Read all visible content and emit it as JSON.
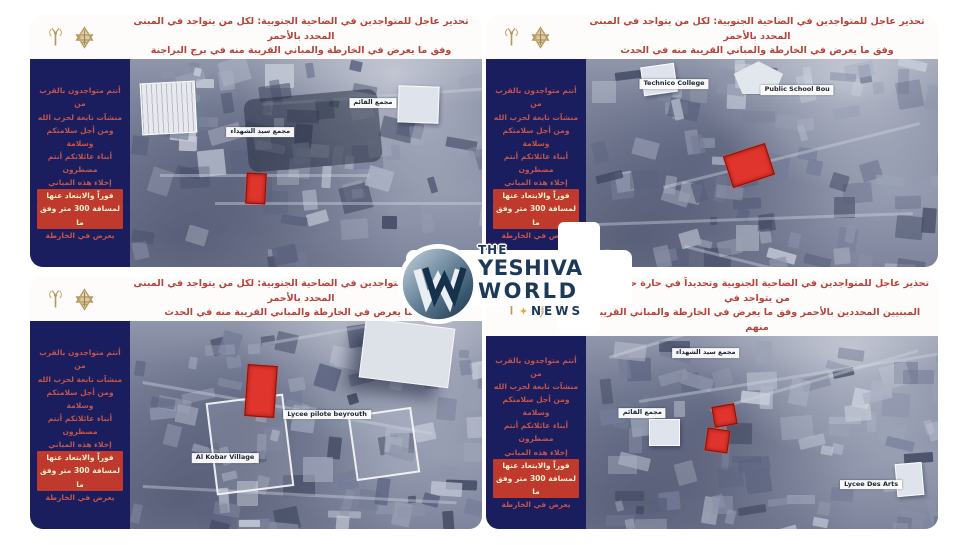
{
  "watermark": {
    "line1": "THE",
    "line2": "YESHIVA",
    "line3": "WORLD",
    "line4": "NEWS",
    "monogram": "W"
  },
  "colors": {
    "warning_red": "#b5443d",
    "sidebar_navy": "#1a1e5e",
    "highlight_red": "#bf392c",
    "gold": "#b6985a",
    "target_red": "#e0352c",
    "watermark_navy": "#1c3a57"
  },
  "header_icons": [
    {
      "name": "antenna-icon"
    },
    {
      "name": "idf-emblem-icon"
    }
  ],
  "sidebar_warning": {
    "lines": [
      {
        "text": "أنتم متواجدون بالقرب من",
        "hl": false
      },
      {
        "text": "منشآت تابعة لحزب الله",
        "hl": false
      },
      {
        "text": "ومن أجل سلامتكم وسلامة",
        "hl": false
      },
      {
        "text": "أبناء عائلاتكم أنتم مضطرون",
        "hl": false
      },
      {
        "text": "إخلاء هذه المباني",
        "hl": false
      },
      {
        "text": "فوراً والابتعاد عنها",
        "hl": true
      },
      {
        "text": "لمسافة 300 متر وفق ما",
        "hl": true
      },
      {
        "text": "يعرض في الخارطة",
        "hl": false
      }
    ]
  },
  "quadrants": [
    {
      "id": "top-left",
      "seed": 11,
      "header": {
        "line1": "تحذير عاجل للمتواجدين في الضاحية الجنوبية: لكل من يتواجد في المبنى المحدد بالأحمر",
        "line2": "وفق ما يعرض في الخارطة والمباني القريبة منه في برج البراجنة"
      },
      "map": {
        "labels": [
          {
            "text": "مجمع سيد الشهداء",
            "x": 37,
            "y": 35
          },
          {
            "text": "مجمع القائم",
            "x": 69,
            "y": 21
          }
        ],
        "targets": [
          {
            "x": 33,
            "y": 55,
            "w": 5,
            "h": 14,
            "rot": 3
          }
        ],
        "landmarks": [
          {
            "kind": "grid-building",
            "x": 3,
            "y": 11,
            "w": 15,
            "h": 24,
            "rot": -3
          },
          {
            "kind": "dark",
            "x": 33,
            "y": 17,
            "w": 38,
            "h": 35,
            "rot": -5
          },
          {
            "kind": "white",
            "x": 76,
            "y": 13,
            "w": 11,
            "h": 17,
            "rot": 2
          }
        ]
      }
    },
    {
      "id": "top-right",
      "seed": 22,
      "header": {
        "line1": "تحذير عاجل للمتواجدين في الضاحية الجنوبية: لكل من يتواجد في المبنى المحدد بالأحمر",
        "line2": "وفق ما يعرض في الخارطة والمباني القريبة منه في الحدث"
      },
      "map": {
        "labels": [
          {
            "text": "Technico College",
            "x": 25,
            "y": 12
          },
          {
            "text": "Public School Bou",
            "x": 60,
            "y": 15
          }
        ],
        "targets": [
          {
            "x": 40,
            "y": 43,
            "w": 12,
            "h": 15,
            "rot": -18
          }
        ],
        "landmarks": [
          {
            "kind": "pentagon",
            "x": 42,
            "y": 1,
            "w": 14,
            "h": 16,
            "rot": 0
          },
          {
            "kind": "white",
            "x": 16,
            "y": 3,
            "w": 9,
            "h": 13,
            "rot": -8
          }
        ]
      }
    },
    {
      "id": "bottom-left",
      "seed": 33,
      "header": {
        "line1": "تحذير عاجل للمتواجدين في الضاحية الجنوبية: لكل من يتواجد في المبنى المحدد بالأحمر",
        "line2": "وفق ما يعرض في الخارطة والمباني القريبة منه في الحدث"
      },
      "map": {
        "labels": [
          {
            "text": "Lycee pilote beyrouth",
            "x": 56,
            "y": 45
          },
          {
            "text": "Al Kobar Village",
            "x": 27,
            "y": 66
          }
        ],
        "targets": [
          {
            "x": 33,
            "y": 21,
            "w": 8,
            "h": 24,
            "rot": 4
          }
        ],
        "landmarks": [
          {
            "kind": "shadow-building",
            "x": 66,
            "y": 1,
            "w": 25,
            "h": 28,
            "rot": 7
          },
          {
            "kind": "outline",
            "x": 23,
            "y": 37,
            "w": 21,
            "h": 43,
            "rot": -7
          },
          {
            "kind": "outline",
            "x": 63,
            "y": 43,
            "w": 17,
            "h": 30,
            "rot": -8
          }
        ]
      }
    },
    {
      "id": "bottom-right",
      "seed": 44,
      "header": {
        "line1": "تحذير عاجل للمتواجدين في الضاحية الجنوبية وتحديداً في حارة حريك ولكل من يتواجد في",
        "line2": "المبنيين المحددين بالأحمر وفق ما يعرض في الخارطة والمباني القريبة منهم"
      },
      "map": {
        "labels": [
          {
            "text": "مجمع سيد الشهداء",
            "x": 34,
            "y": 9
          },
          {
            "text": "مجمع القائم",
            "x": 16,
            "y": 40
          },
          {
            "text": "Lycee Des Arts",
            "x": 81,
            "y": 77
          }
        ],
        "targets": [
          {
            "x": 36,
            "y": 36,
            "w": 6,
            "h": 10,
            "rot": -10
          },
          {
            "x": 34,
            "y": 48,
            "w": 6,
            "h": 11,
            "rot": 8
          }
        ],
        "landmarks": [
          {
            "kind": "white",
            "x": 18,
            "y": 43,
            "w": 8,
            "h": 13,
            "rot": 0
          },
          {
            "kind": "white",
            "x": 88,
            "y": 66,
            "w": 7,
            "h": 16,
            "rot": -5
          }
        ]
      }
    }
  ]
}
